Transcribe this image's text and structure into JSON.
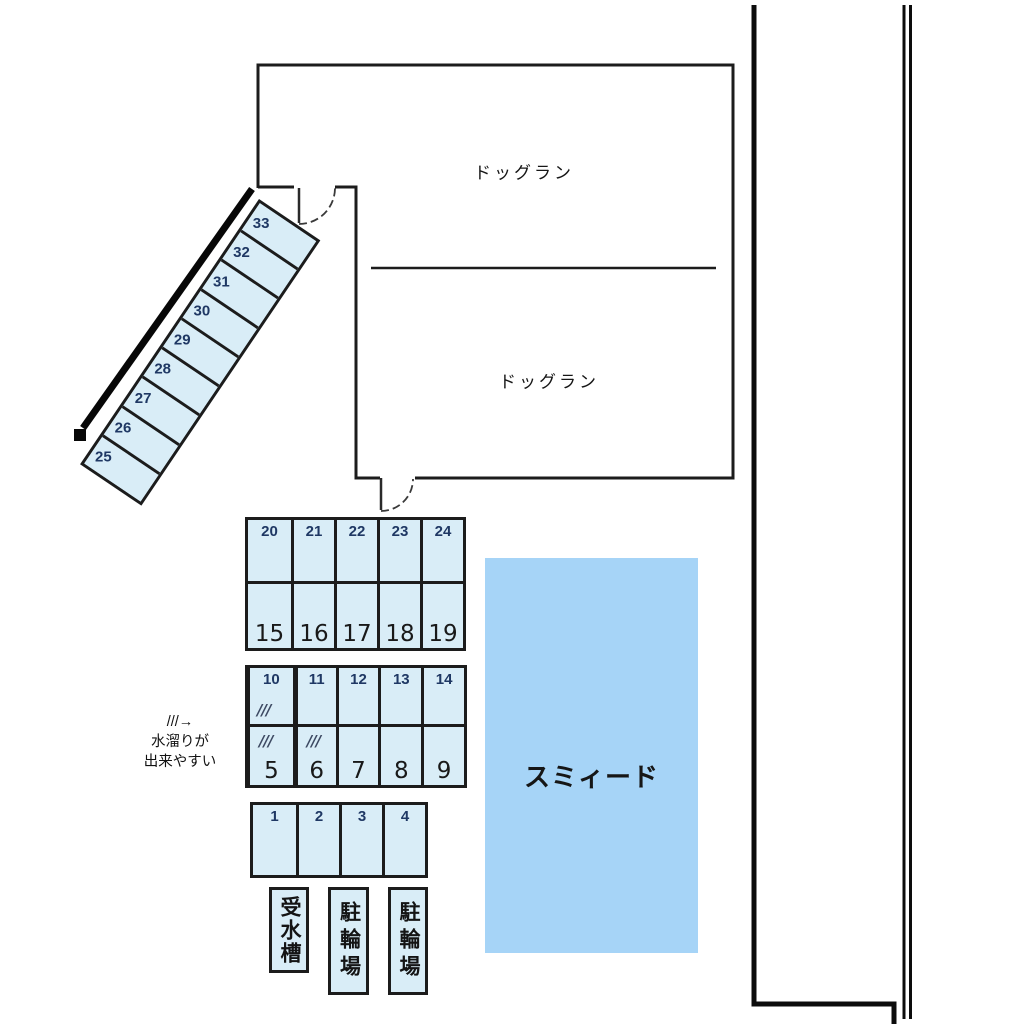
{
  "plan": {
    "dog_run": {
      "upper_label": "ドッグラン",
      "lower_label": "ドッグラン"
    },
    "building_label": "スミィード",
    "note": {
      "l1": "///→",
      "l2": "水溜りが",
      "l3": "出来やすい"
    },
    "water_tank_label": "受水槽",
    "bike_parking_1_label": "駐輪場",
    "bike_parking_2_label": "駐輪場",
    "hatch_mark": "///",
    "spaces": {
      "diagonal": [
        "33",
        "32",
        "31",
        "30",
        "29",
        "28",
        "27",
        "26",
        "25"
      ],
      "grid_a_top": [
        "20",
        "21",
        "22",
        "23",
        "24"
      ],
      "grid_a_bottom": [
        "15",
        "16",
        "17",
        "18",
        "19"
      ],
      "grid_b_top": [
        "10",
        "11",
        "12",
        "13",
        "14"
      ],
      "grid_b_bottom": [
        "5",
        "6",
        "7",
        "8",
        "9"
      ],
      "grid_c": [
        "1",
        "2",
        "3",
        "4"
      ]
    },
    "colors": {
      "space_fill": "#d9edf7",
      "building_fill": "#a6d4f7",
      "wall_line": "#1c1c1c",
      "number_navy": "#1f3864"
    }
  }
}
